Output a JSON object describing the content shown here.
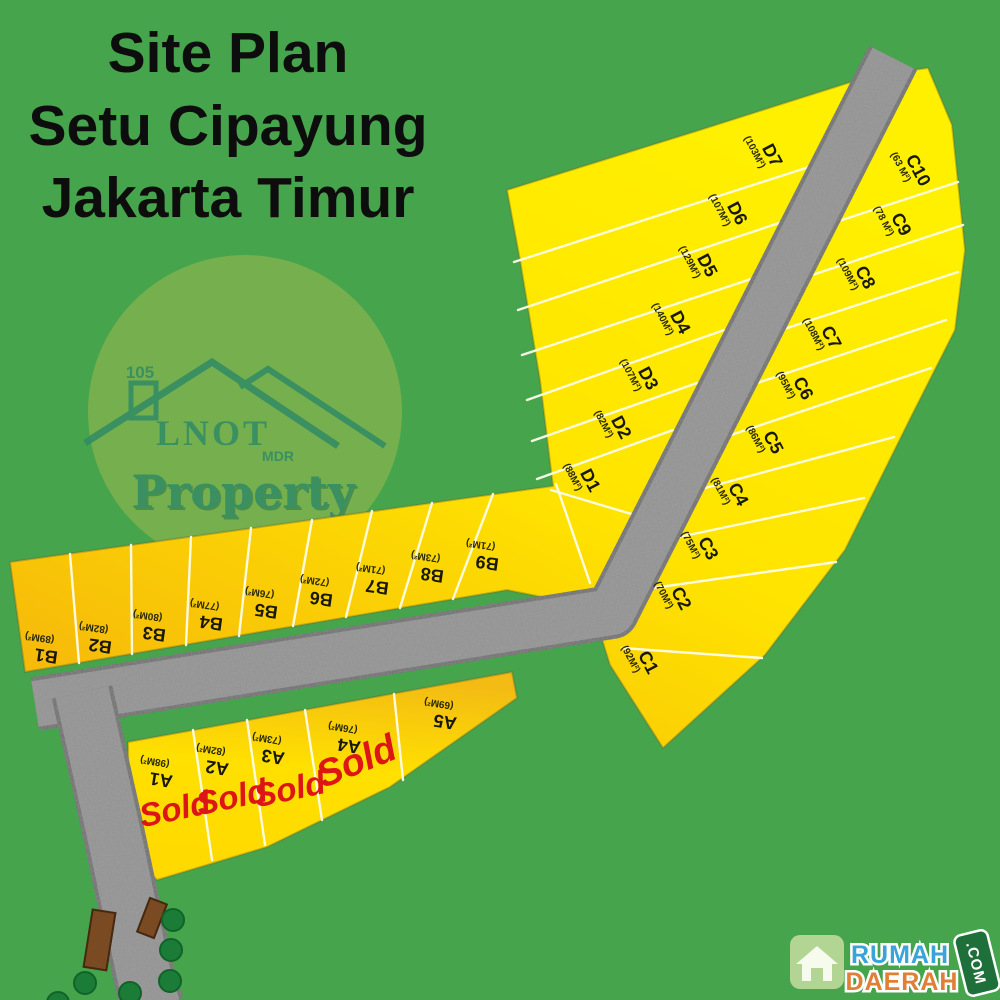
{
  "title": {
    "lines": [
      "Site Plan",
      "Setu Cipayung",
      "Jakarta Timur"
    ]
  },
  "logo": {
    "number": "105",
    "name": "LNOT",
    "sub": "MDR",
    "word": "Property"
  },
  "watermark": {
    "top": "RUMAH",
    "bottom": "DAERAH",
    "tld": ".COM"
  },
  "sold_text": "Sold",
  "colors": {
    "background_green": "#46a44c",
    "plot_yellow": "#ffe800",
    "plot_gold": "#f6b90a",
    "road_gray": "#909090",
    "sold_red": "#de1515",
    "logo_teal": "#2f8a66",
    "logo_circle": "#7ab04f",
    "watermark_blue": "#3aa4d8",
    "watermark_orange": "#e07f35",
    "post_brown": "#7a4a22",
    "dot_green": "#1b7c38"
  },
  "plots": [
    {
      "id": "A1",
      "area": "(98M²)",
      "sold": true
    },
    {
      "id": "A2",
      "area": "(82M²)",
      "sold": true
    },
    {
      "id": "A3",
      "area": "(73M²)",
      "sold": true
    },
    {
      "id": "A4",
      "area": "(76M²)",
      "sold": true
    },
    {
      "id": "A5",
      "area": "(69M²)",
      "sold": false
    },
    {
      "id": "B1",
      "area": "(89M²)",
      "sold": false
    },
    {
      "id": "B2",
      "area": "(82M²)",
      "sold": false
    },
    {
      "id": "B3",
      "area": "(80M²)",
      "sold": false
    },
    {
      "id": "B4",
      "area": "(77M²)",
      "sold": false
    },
    {
      "id": "B5",
      "area": "(76M²)",
      "sold": false
    },
    {
      "id": "B6",
      "area": "(72M²)",
      "sold": false
    },
    {
      "id": "B7",
      "area": "(71M²)",
      "sold": false
    },
    {
      "id": "B8",
      "area": "(73M²)",
      "sold": false
    },
    {
      "id": "B9",
      "area": "(71M²)",
      "sold": false
    },
    {
      "id": "C1",
      "area": "(92M²)",
      "sold": false
    },
    {
      "id": "C2",
      "area": "(70M²)",
      "sold": false
    },
    {
      "id": "C3",
      "area": "(75M²)",
      "sold": false
    },
    {
      "id": "C4",
      "area": "(81M²)",
      "sold": false
    },
    {
      "id": "C5",
      "area": "(86M²)",
      "sold": false
    },
    {
      "id": "C6",
      "area": "(95M²)",
      "sold": false
    },
    {
      "id": "C7",
      "area": "(108M²)",
      "sold": false
    },
    {
      "id": "C8",
      "area": "(109M²)",
      "sold": false
    },
    {
      "id": "C9",
      "area": "(78 M²)",
      "sold": false
    },
    {
      "id": "C10",
      "area": "(63 M²)",
      "sold": false
    },
    {
      "id": "D1",
      "area": "(88M²)",
      "sold": false
    },
    {
      "id": "D2",
      "area": "(82M²)",
      "sold": false
    },
    {
      "id": "D3",
      "area": "(107M²)",
      "sold": false
    },
    {
      "id": "D4",
      "area": "(140M²)",
      "sold": false
    },
    {
      "id": "D5",
      "area": "(129M²)",
      "sold": false
    },
    {
      "id": "D6",
      "area": "(107M²)",
      "sold": false
    },
    {
      "id": "D7",
      "area": "(103M²)",
      "sold": false
    }
  ]
}
